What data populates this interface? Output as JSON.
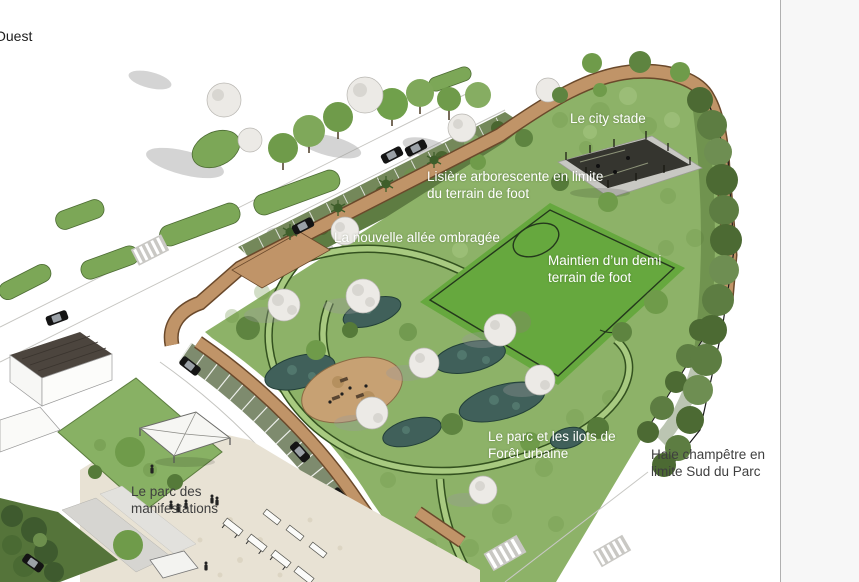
{
  "compass": {
    "label": "Ouest"
  },
  "annotations": {
    "city_stade": {
      "lines": [
        "Le city stade"
      ]
    },
    "lisiere": {
      "lines": [
        "Lisière arborescente en limite",
        "du terrain de foot"
      ]
    },
    "nouvelle_allee": {
      "lines": [
        "La nouvelle allée ombragée"
      ]
    },
    "demi_terrain": {
      "lines": [
        "Maintien d’un demi",
        "terrain de foot"
      ]
    },
    "parc_ilots": {
      "lines": [
        "Le parc et les ilots de",
        "Forêt urbaine"
      ]
    },
    "haie": {
      "lines": [
        "Haie champêtre en",
        "limite Sud du Parc"
      ]
    },
    "manifestations": {
      "lines": [
        "Le parc des",
        "manifestations"
      ]
    }
  },
  "palette": {
    "park_green": "#8db268",
    "field_green": "#66a83e",
    "hedge_green": "#4c6a33",
    "path_tan": "#c09468",
    "pond_teal": "#40605a",
    "plaza_beige": "#e8e2d4",
    "panel_gray": "#f7f7f7",
    "label_white": "#ffffff",
    "label_dark": "#3f3f3f"
  }
}
